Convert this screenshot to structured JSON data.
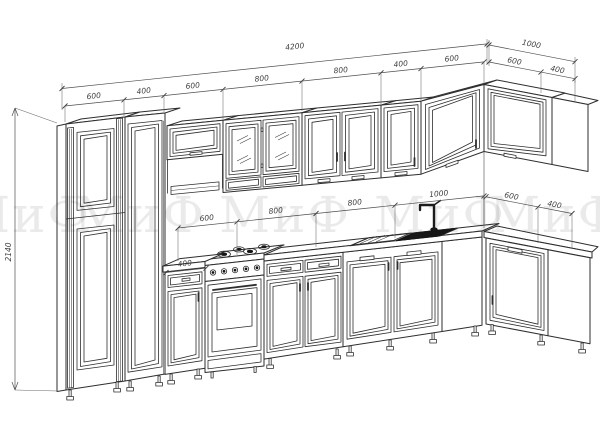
{
  "drawing": {
    "kind": "kitchen-elevation-technical-drawing",
    "colors": {
      "background": "#ffffff",
      "line": "#2e2e2e",
      "dimension_line": "#4f4f4f",
      "sink_basin": "#161616",
      "watermark": "#eeeeee"
    }
  },
  "watermark": {
    "items": [
      "МиФ",
      "МиФ",
      "МиФ",
      "МиФ",
      "МиФ"
    ]
  },
  "dimensions": {
    "overall_width": "4200",
    "overall_return": "1000",
    "height": "2140",
    "base_cabinet": "400",
    "top_chain": [
      "600",
      "400",
      "600",
      "800",
      "800",
      "400",
      "600"
    ],
    "top_return_chain": [
      "600",
      "400"
    ],
    "middle_chain": [
      "600",
      "800",
      "800",
      "1000"
    ],
    "middle_return_chain": [
      "600",
      "400"
    ]
  }
}
